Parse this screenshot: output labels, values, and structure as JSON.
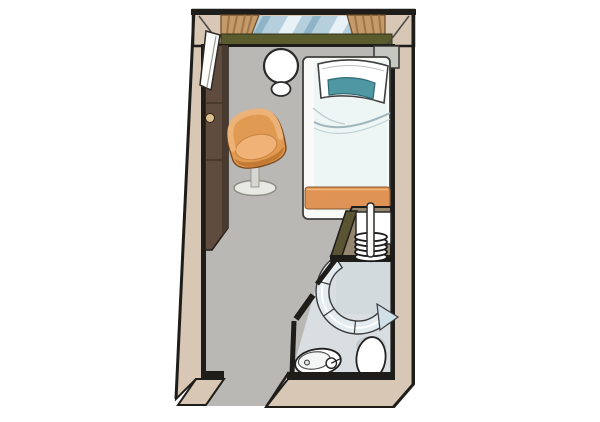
{
  "scene": {
    "kind": "floor-plan-illustration",
    "subject": "single cabin with en-suite bathroom"
  },
  "colors": {
    "background": "#ffffff",
    "outline": "#1f1d1a",
    "wall_band": "#d8c7b5",
    "floor": "#b9b8b4",
    "wardrobe": "#5f4c3e",
    "wardrobe_dark": "#493a2f",
    "knob": "#dcc18c",
    "window_glass": "#b5cfdd",
    "glass_stripe_light": "#e7f1f6",
    "glass_stripe_dark": "#8fb4c8",
    "curtain": "#c59a6b",
    "curtain_fold": "#9e7448",
    "windowsill": "#5a5c2e",
    "door_leaf": "#fcfcfb",
    "table": "#ffffff",
    "chair_body": "#e09a52",
    "chair_seat": "#f0b277",
    "chair_front": "#c47a33",
    "chair_base": "#e9e9e4",
    "bed_frame": "#fafaf8",
    "duvet": "#eef5f5",
    "duvet_fold": "#9fb6bc",
    "pillow": "#ffffff",
    "pillow_accent": "#4f98a3",
    "bed_runner": "#df9355",
    "niche_top": "#95866f",
    "niche_olive": "#5a5433",
    "rack_box": "#ffffff",
    "bath_floor": "#d9dee2",
    "shower_floor": "#d3dadd",
    "shower_glass": "#e3ecf0",
    "shower_fin": "#cfe0e9",
    "fixture": "#ffffff",
    "fixture_shadow": "#c3cbd1",
    "ledge": "#c7c7c2"
  },
  "items": [
    {
      "id": "walls",
      "label": "outer walls"
    },
    {
      "id": "window",
      "label": "panoramic window"
    },
    {
      "id": "curtains",
      "label": "curtains"
    },
    {
      "id": "windowsill",
      "label": "windowsill"
    },
    {
      "id": "entry",
      "label": "entry opening"
    },
    {
      "id": "wardrobe",
      "label": "wardrobe"
    },
    {
      "id": "door-leaf",
      "label": "open door leaf"
    },
    {
      "id": "table",
      "label": "round table"
    },
    {
      "id": "stool",
      "label": "stool"
    },
    {
      "id": "chair",
      "label": "swivel tub chair"
    },
    {
      "id": "bed",
      "label": "single bed"
    },
    {
      "id": "pillow",
      "label": "pillow with teal accent"
    },
    {
      "id": "bed-runner",
      "label": "bed runner"
    },
    {
      "id": "rack",
      "label": "luggage rack with coil heater"
    },
    {
      "id": "bathroom",
      "label": "en-suite bathroom"
    },
    {
      "id": "shower",
      "label": "curved shower enclosure"
    },
    {
      "id": "sink",
      "label": "washbasin"
    },
    {
      "id": "toilet",
      "label": "toilet"
    }
  ]
}
